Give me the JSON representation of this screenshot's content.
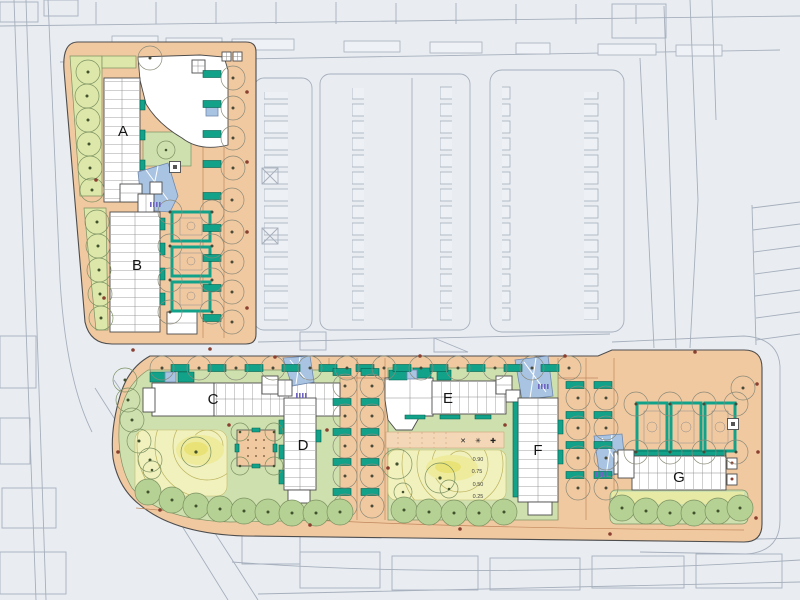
{
  "plan": {
    "type": "architectural-site-plan",
    "blocks": [
      {
        "label": "A"
      },
      {
        "label": "B"
      },
      {
        "label": "C"
      },
      {
        "label": "D"
      },
      {
        "label": "E"
      },
      {
        "label": "F"
      },
      {
        "label": "G"
      }
    ],
    "contour_labels": [
      "0.90",
      "0.75",
      "0.50",
      "0.25"
    ],
    "play_markings": [
      "✕",
      "✳",
      "✚"
    ]
  },
  "colors": {
    "background": "#e9edf2",
    "paving": "#f1c9a1",
    "lawn": "#cfe0af",
    "lawn_strip": "#dce7a9",
    "mound_outer": "#f0f1bc",
    "mound_mid": "#eeeb9d",
    "mound_core": "#e9e276",
    "teal": "#12a28a",
    "blue_roof": "#a9c4e3",
    "building": "#ffffff",
    "building_line": "#4c4c4c",
    "context_line": "#a6afbc",
    "lane_line": "#c0875c",
    "shrub": "#b5d193",
    "lamp": "#8a4030",
    "purple": "#6f63c0",
    "label": "#141414",
    "parcel_line": "#4d4d4d"
  }
}
